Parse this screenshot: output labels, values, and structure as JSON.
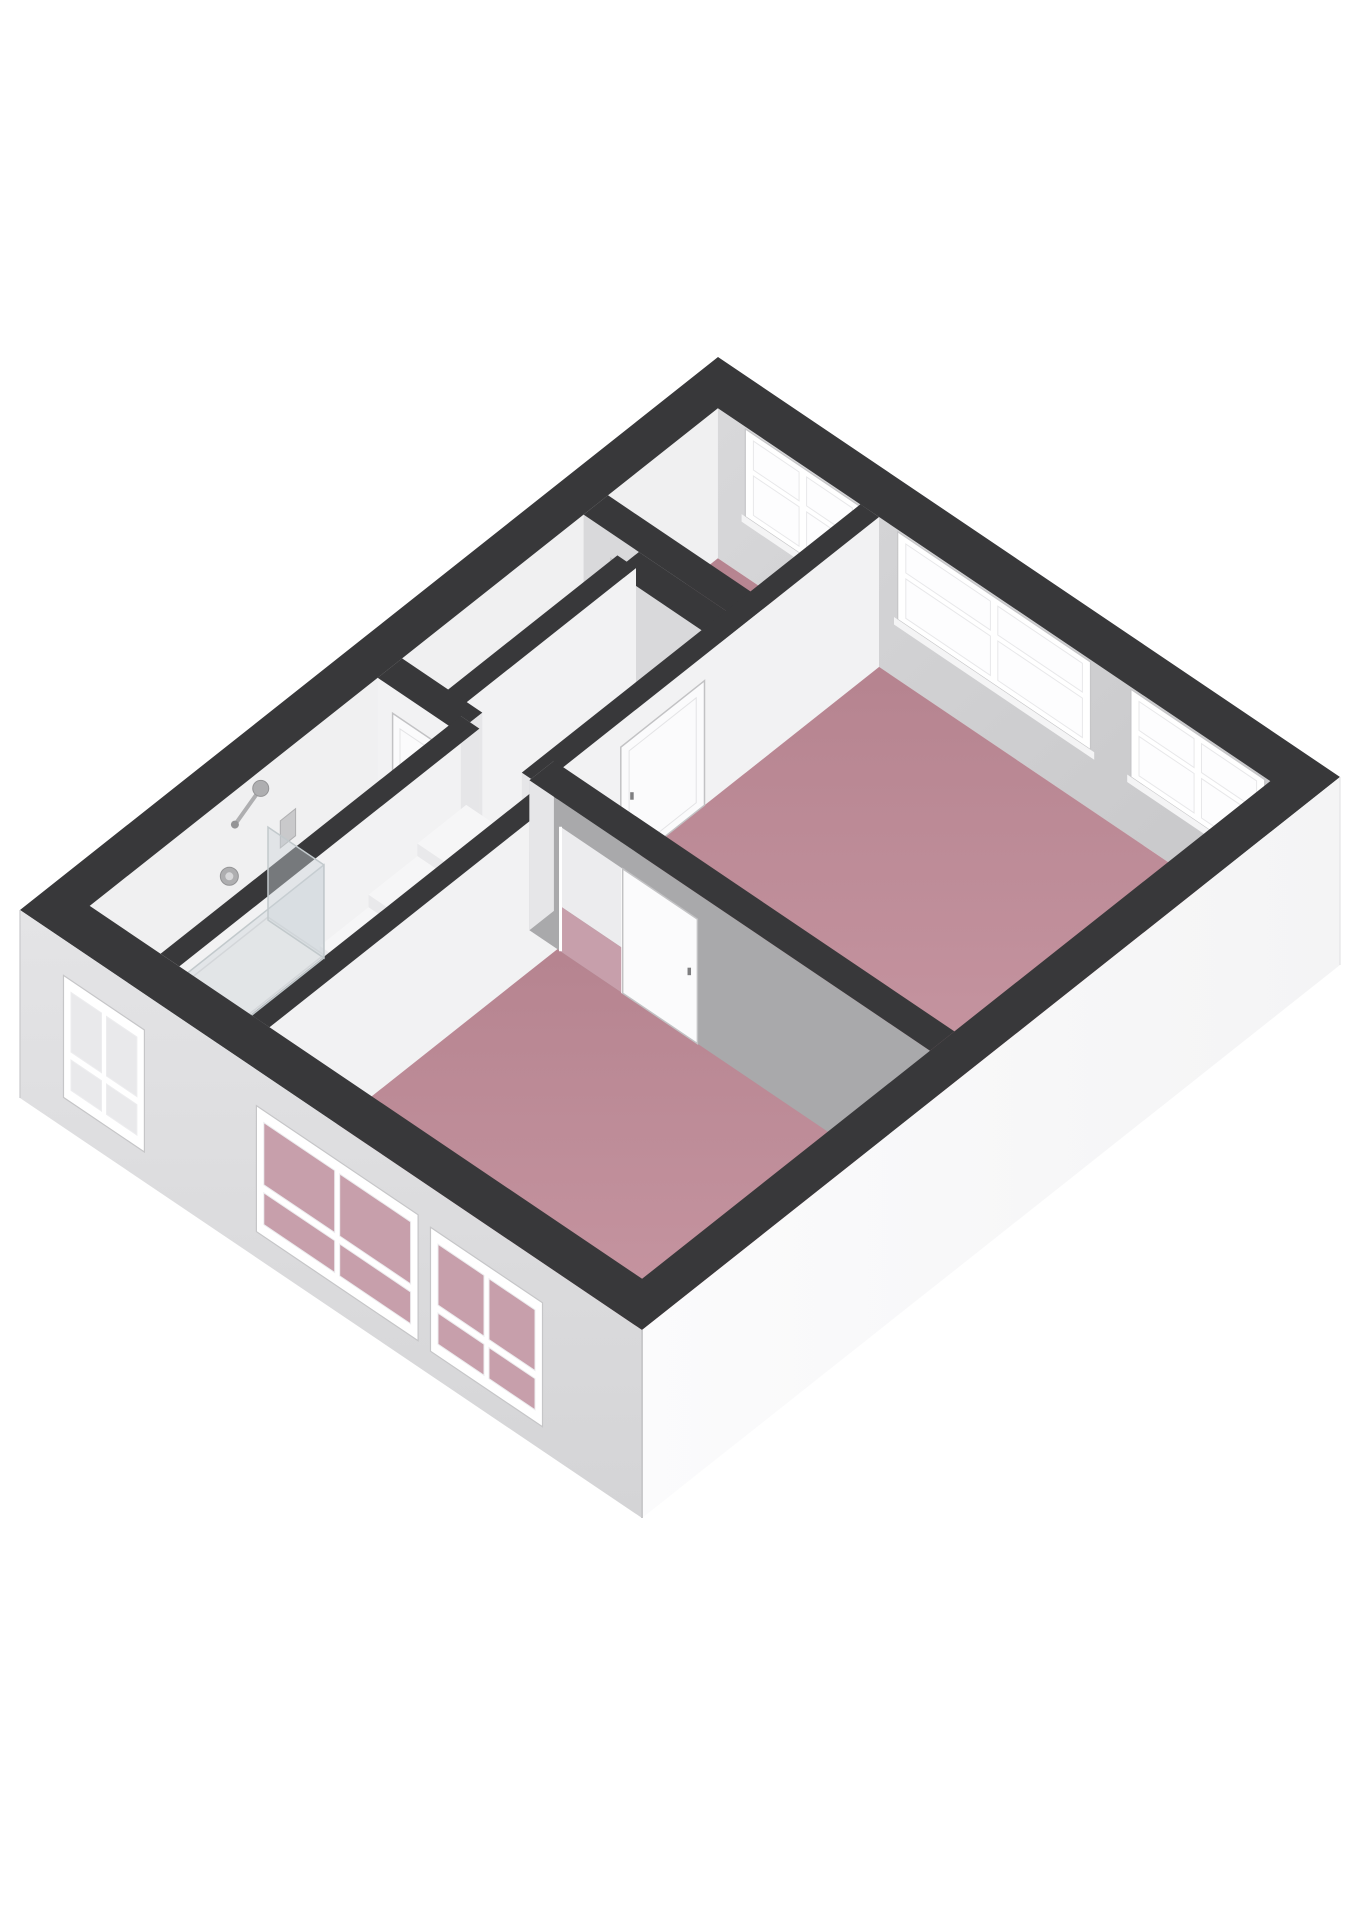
{
  "page": {
    "background": "#ffffff",
    "description": "3D isometric floor plan render, one storey, no text labels"
  },
  "canvas": {
    "width": 1358,
    "height": 1920
  },
  "palette": {
    "cap": "#38383a",
    "cap_edge": "#2e2e30",
    "inner_ne": "#cfcfd1",
    "inner_ne_light": "#d8d8da",
    "inner_nw": "#f0f0f1",
    "face_lit": "#f2f2f3",
    "face_mid": "#d9d9db",
    "face_shadow": "#a9a9ab",
    "face_end": "#e6e6e8",
    "floor_pink_light": "#cb9aa6",
    "floor_pink_dark": "#b5838f",
    "floor_hall_light": "#cacace",
    "floor_hall_dark": "#bdbdbf",
    "floor_stair": "#c2c2c4",
    "floor_bath": "#eaeaec",
    "floor_wc": "#d2d2d4",
    "ext_se": "#f7f7f8",
    "ext_se_light": "#fbfbfc",
    "ext_sw": "#e1e1e3",
    "ext_sw_dark": "#d4d4d6",
    "frame": "#ffffff",
    "frame_edge": "#c6c6c8",
    "glass": "#fdfdfe",
    "glass_pink": "#c79fab",
    "glass_bath": "#e9e9eb",
    "door_leaf": "#fbfbfc",
    "door_edge": "#c2c2c4",
    "handle": "#7e7e80",
    "metal": "#aeaeb0",
    "metal_dark": "#949496",
    "shower_glass": "rgba(206,213,217,0.42)",
    "shower_edge": "#c2c9cc",
    "step_top": "#f6f6f7",
    "step_front": "#e9e9eb",
    "step_side": "#dcdcde",
    "baluster": "#d2d2d4",
    "opening_back": "#ececee"
  },
  "geometry": {
    "origin": [
      718,
      357
    ],
    "axis_a": [
      622,
      420
    ],
    "axis_b": [
      -698,
      553
    ],
    "wall_height": 150,
    "exterior_drop": 188,
    "ext_thickness": {
      "s": 0.056,
      "t": 0.05
    },
    "int_thickness": {
      "s": 0.03,
      "t": 0.035
    }
  },
  "inner_faces": [
    {
      "name": "nw-wall-inner-face",
      "plane": "s",
      "pos": 0.056,
      "from": 0.05,
      "to": 0.95,
      "color": "inner_nw"
    },
    {
      "name": "ne-wall-inner-face",
      "plane": "t",
      "pos": 0.05,
      "from": 0.056,
      "to": 0.944,
      "color": "inner_ne"
    }
  ],
  "rooms": [
    {
      "name": "floor-small-bedroom",
      "kind": "pink",
      "s0": 0.056,
      "t0": 0.05,
      "s1": 0.315,
      "t1": 0.225
    },
    {
      "name": "floor-hallway",
      "kind": "hall",
      "s0": 0.056,
      "t0": 0.225,
      "s1": 0.315,
      "t1": 0.52
    },
    {
      "name": "floor-wc",
      "kind": "wc",
      "s0": 0.145,
      "t0": 0.26,
      "s1": 0.3,
      "t1": 0.52
    },
    {
      "name": "floor-living-room",
      "kind": "pink",
      "s0": 0.285,
      "t0": 0.05,
      "s1": 0.944,
      "t1": 0.535
    },
    {
      "name": "floor-stairwell",
      "kind": "stair",
      "s0": 0.17,
      "t0": 0.5,
      "s1": 0.345,
      "t1": 0.95
    },
    {
      "name": "floor-bathroom",
      "kind": "bath",
      "s0": 0.056,
      "t0": 0.52,
      "s1": 0.185,
      "t1": 0.95
    },
    {
      "name": "floor-bedroom",
      "kind": "pink",
      "s0": 0.33,
      "t0": 0.52,
      "s1": 0.944,
      "t1": 0.95
    }
  ],
  "ne_windows": [
    {
      "name": "window-ne-small-bedroom",
      "s0": 0.1,
      "s1": 0.285,
      "z0": 0.4,
      "z1": 0.985,
      "transom": 0.56,
      "glass": "glass"
    },
    {
      "name": "window-ne-living-1",
      "s0": 0.345,
      "s1": 0.655,
      "z0": 0.4,
      "z1": 0.985,
      "transom": 0.56,
      "glass": "glass"
    },
    {
      "name": "window-ne-living-2",
      "s0": 0.72,
      "s1": 0.935,
      "z0": 0.4,
      "z1": 0.985,
      "transom": 0.56,
      "glass": "glass"
    }
  ],
  "interior_walls": [
    {
      "name": "wall-small-bedroom-sw",
      "plane": "t",
      "pos": 0.225,
      "from": 0.056,
      "to": 0.315,
      "face": "face_mid",
      "door": {
        "name": "door-small-bedroom",
        "type": "closed",
        "from": 0.1,
        "to": 0.19
      },
      "ends": [
        0.315
      ]
    },
    {
      "name": "wall-wc-ne",
      "plane": "t",
      "pos": 0.26,
      "from": 0.145,
      "to": 0.315,
      "face": "face_mid",
      "ends": []
    },
    {
      "name": "wall-wc-nw",
      "plane": "s",
      "pos": 0.145,
      "from": 0.26,
      "to": 0.52,
      "face": "face_lit",
      "ends": [
        0.52
      ]
    },
    {
      "name": "wall-living-nw",
      "plane": "s",
      "pos": 0.3,
      "from": 0.05,
      "to": 0.535,
      "face": "face_lit",
      "door": {
        "name": "door-living-room",
        "type": "closed",
        "from": 0.3,
        "to": 0.42
      },
      "ends": [
        0.535
      ]
    },
    {
      "name": "wall-bathroom-ne",
      "plane": "t",
      "pos": 0.52,
      "from": 0.056,
      "to": 0.185,
      "face": "face_lit",
      "door": {
        "name": "door-bathroom",
        "type": "closed",
        "from": 0.08,
        "to": 0.165
      },
      "ends": [
        0.185
      ]
    },
    {
      "name": "wall-bathroom-stair-divider",
      "plane": "s",
      "pos": 0.185,
      "from": 0.52,
      "to": 0.95,
      "face": "face_lit",
      "ends": [
        0.52
      ]
    }
  ],
  "stairs": {
    "name": "staircase",
    "s0": 0.19,
    "s1": 0.325,
    "t0": 0.53,
    "t1": 0.95,
    "steps": 6,
    "top_z": 0.5,
    "balusters": 10,
    "rail_h": 0.36
  },
  "front_walls": [
    {
      "name": "wall-stair-bedroom-divider",
      "plane": "s",
      "pos": 0.33,
      "from": 0.52,
      "to": 0.95,
      "face": "face_lit",
      "ends": [
        0.52
      ]
    },
    {
      "name": "wall-bedroom-ne",
      "plane": "t",
      "pos": 0.52,
      "from": 0.3,
      "to": 0.944,
      "face": "face_shadow",
      "door": {
        "name": "door-bedroom-open",
        "type": "open",
        "from": 0.35,
        "to": 0.45,
        "leaf_to": 0.57
      },
      "ends": [
        0.3
      ]
    }
  ],
  "shower": {
    "name": "shower-enclosure",
    "tray": {
      "s0": 0.062,
      "t0": 0.7,
      "s1": 0.152,
      "t1": 0.945
    },
    "glass_top": 0.62,
    "panels": [
      {
        "plane": "s",
        "pos": 0.152,
        "from": 0.7,
        "to": 0.945
      },
      {
        "plane": "t",
        "pos": 0.7,
        "from": 0.062,
        "to": 0.152
      }
    ],
    "head": {
      "t": 0.705,
      "z": 0.88,
      "r": 8
    },
    "valve": {
      "t": 0.75,
      "z": 0.46,
      "r": 9
    },
    "panel": {
      "t": 0.655,
      "z0": 0.38,
      "z1": 0.56
    }
  },
  "sw_windows": [
    {
      "name": "window-sw-bathroom",
      "s0": 0.07,
      "s1": 0.2,
      "top": 36,
      "bottom": 158,
      "glass": "glass_bath",
      "panes": 2
    },
    {
      "name": "window-sw-bedroom-1",
      "s0": 0.38,
      "s1": 0.64,
      "top": 36,
      "bottom": 162,
      "glass": "glass_pink",
      "panes": 2
    },
    {
      "name": "window-sw-bedroom-2",
      "s0": 0.66,
      "s1": 0.84,
      "top": 40,
      "bottom": 164,
      "glass": "glass_pink",
      "panes": 2
    }
  ]
}
